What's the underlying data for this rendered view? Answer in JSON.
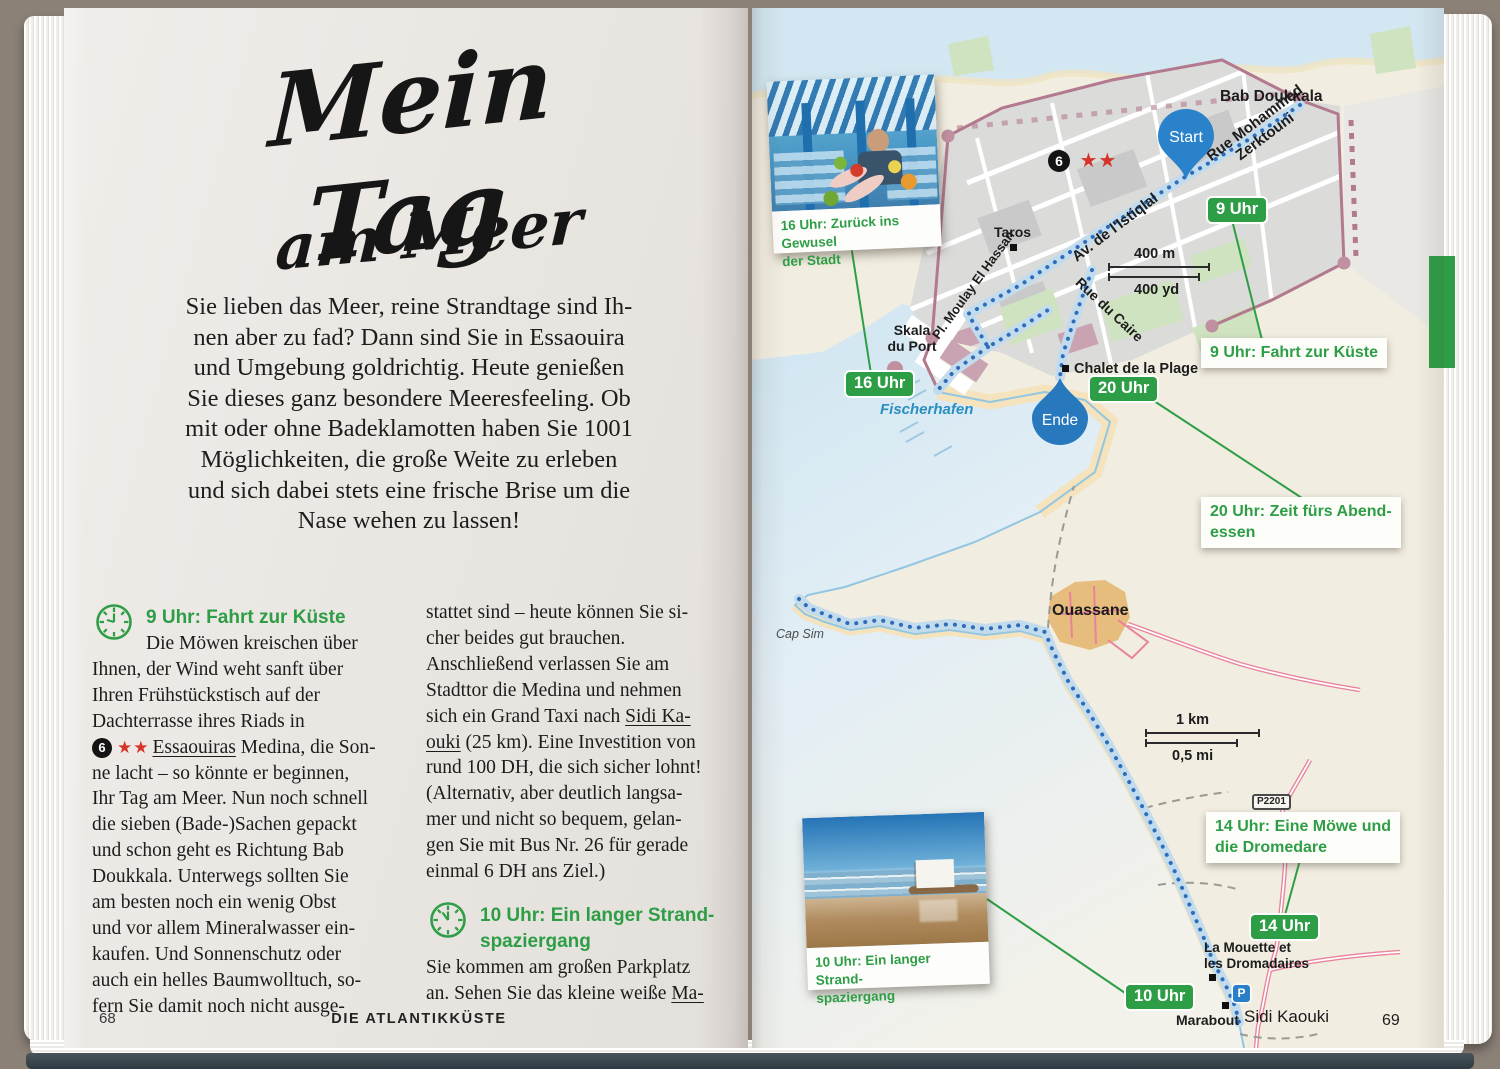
{
  "left_page": {
    "title1": "Mein Tag",
    "title2": "am Meer",
    "intro": [
      "Sie lieben das Meer, reine Strandtage sind Ih-",
      "nen aber zu fad? Dann sind Sie in Essaouira",
      "und Umgebung goldrichtig. Heute genießen",
      "Sie dieses ganz besondere Meeresfeeling. Ob",
      "mit oder ohne Badeklamotten haben Sie 1001",
      "Möglichkeiten, die große Weite zu erleben",
      "und sich dabei stets eine frische Brise um die",
      "Nase wehen zu lassen!"
    ],
    "col1": {
      "heading": "9 Uhr: Fahrt zur Küste",
      "pre": [
        "Die Möwen kreischen über",
        "Ihnen, der Wind weht sanft über",
        "Ihren Frühstückstisch auf der",
        "Dachterrasse ihres Riads in"
      ],
      "poi": {
        "num": "6",
        "stars": "★★",
        "u": "Essaouiras",
        "rest": " Medina, die Son-"
      },
      "post": [
        "ne lacht – so könnte er beginnen,",
        "Ihr Tag am Meer. Nun noch schnell",
        "die sieben (Bade-)Sachen gepackt",
        "und schon geht es Richtung Bab",
        "Doukkala. Unterwegs sollten Sie",
        "am besten noch ein wenig Obst",
        "und vor allem Mineralwasser ein-",
        "kaufen. Und Sonnenschutz oder",
        "auch ein helles Baumwolltuch, so-",
        "fern Sie damit noch nicht ausge-"
      ]
    },
    "col2": {
      "a": [
        "stattet sind – heute können Sie si-",
        "cher beides gut brauchen.",
        "Anschließend verlassen Sie am",
        "Stadttor die Medina und nehmen"
      ],
      "taxi1_pre": "sich ein Grand Taxi nach ",
      "taxi1_u": "Sidi Ka-",
      "taxi2_u": "ouki",
      "taxi2_rest": " (25 km). Eine Investition von",
      "b": [
        "rund 100 DH, die sich sicher lohnt!",
        "(Alternativ, aber deutlich langsa-",
        "mer und nicht so bequem, gelan-",
        "gen Sie mit Bus Nr. 26 für gerade",
        "einmal 6 DH ans Ziel.)"
      ],
      "heading1": "10 Uhr: Ein langer Strand-",
      "heading2": "spaziergang",
      "outro1": "Sie kommen am großen Parkplatz",
      "outro2_pre": "an. Sehen Sie das kleine weiße ",
      "outro2_u": "Ma-"
    },
    "footer_page": "68",
    "footer_chapter": "DIE ATLANTIKKÜSTE"
  },
  "map": {
    "photo1": {
      "cap1": "16 Uhr: Zurück ins Gewusel",
      "cap2": "der Stadt"
    },
    "photo2": {
      "cap1": "10 Uhr: Ein langer Strand-",
      "cap2": "spaziergang"
    },
    "start": "Start",
    "ende": "Ende",
    "poi_num": "6",
    "poi_stars": "★★",
    "badges": {
      "h9": "9 Uhr",
      "h16": "16 Uhr",
      "h20": "20 Uhr",
      "h14": "14 Uhr",
      "h10": "10 Uhr"
    },
    "callouts": {
      "c9": "9 Uhr: Fahrt zur Küste",
      "c20a": "20 Uhr: Zeit fürs Abend-",
      "c20b": "essen",
      "c14a": "14 Uhr: Eine Möwe und",
      "c14b": "die Dromedare"
    },
    "labels": {
      "bab": "Bab Doukkala",
      "rm1": "Rue Mohammed",
      "rm2": "Zerktouni",
      "istiqlal": "Av. de l'Istiqlal",
      "taros": "Taros",
      "moulay": "Pl. Moulay El Hassan",
      "caire": "Rue du Caire",
      "skala1": "Skala",
      "skala2": "du Port",
      "fischerhafen": "Fischerhafen",
      "chalet": "Chalet de la Plage",
      "capsim": "Cap Sim",
      "ouassane": "Ouassane",
      "p2201": "P2201",
      "mouette1": "La Mouette et",
      "mouette2": "les Dromadaires",
      "marabout": "Marabout",
      "sidikaouki": "Sidi Kaouki",
      "parking": "P"
    },
    "scale1": {
      "top": "400 m",
      "bottom": "400 yd"
    },
    "scale2": {
      "top": "1 km",
      "bottom": "0,5 mi"
    },
    "footer_page": "69"
  },
  "colors": {
    "accent_green": "#2e9e46",
    "route_blue": "#2f6db8",
    "route_casing": "#c2dcee",
    "marker_blue": "#2a82ca",
    "sea": "#d3e7f2",
    "land": "#f1ede0",
    "wall_mauve": "#b2798f",
    "road_pink": "#e8839c",
    "village_tan": "#e7bd7d",
    "star_red": "#d4342a"
  }
}
